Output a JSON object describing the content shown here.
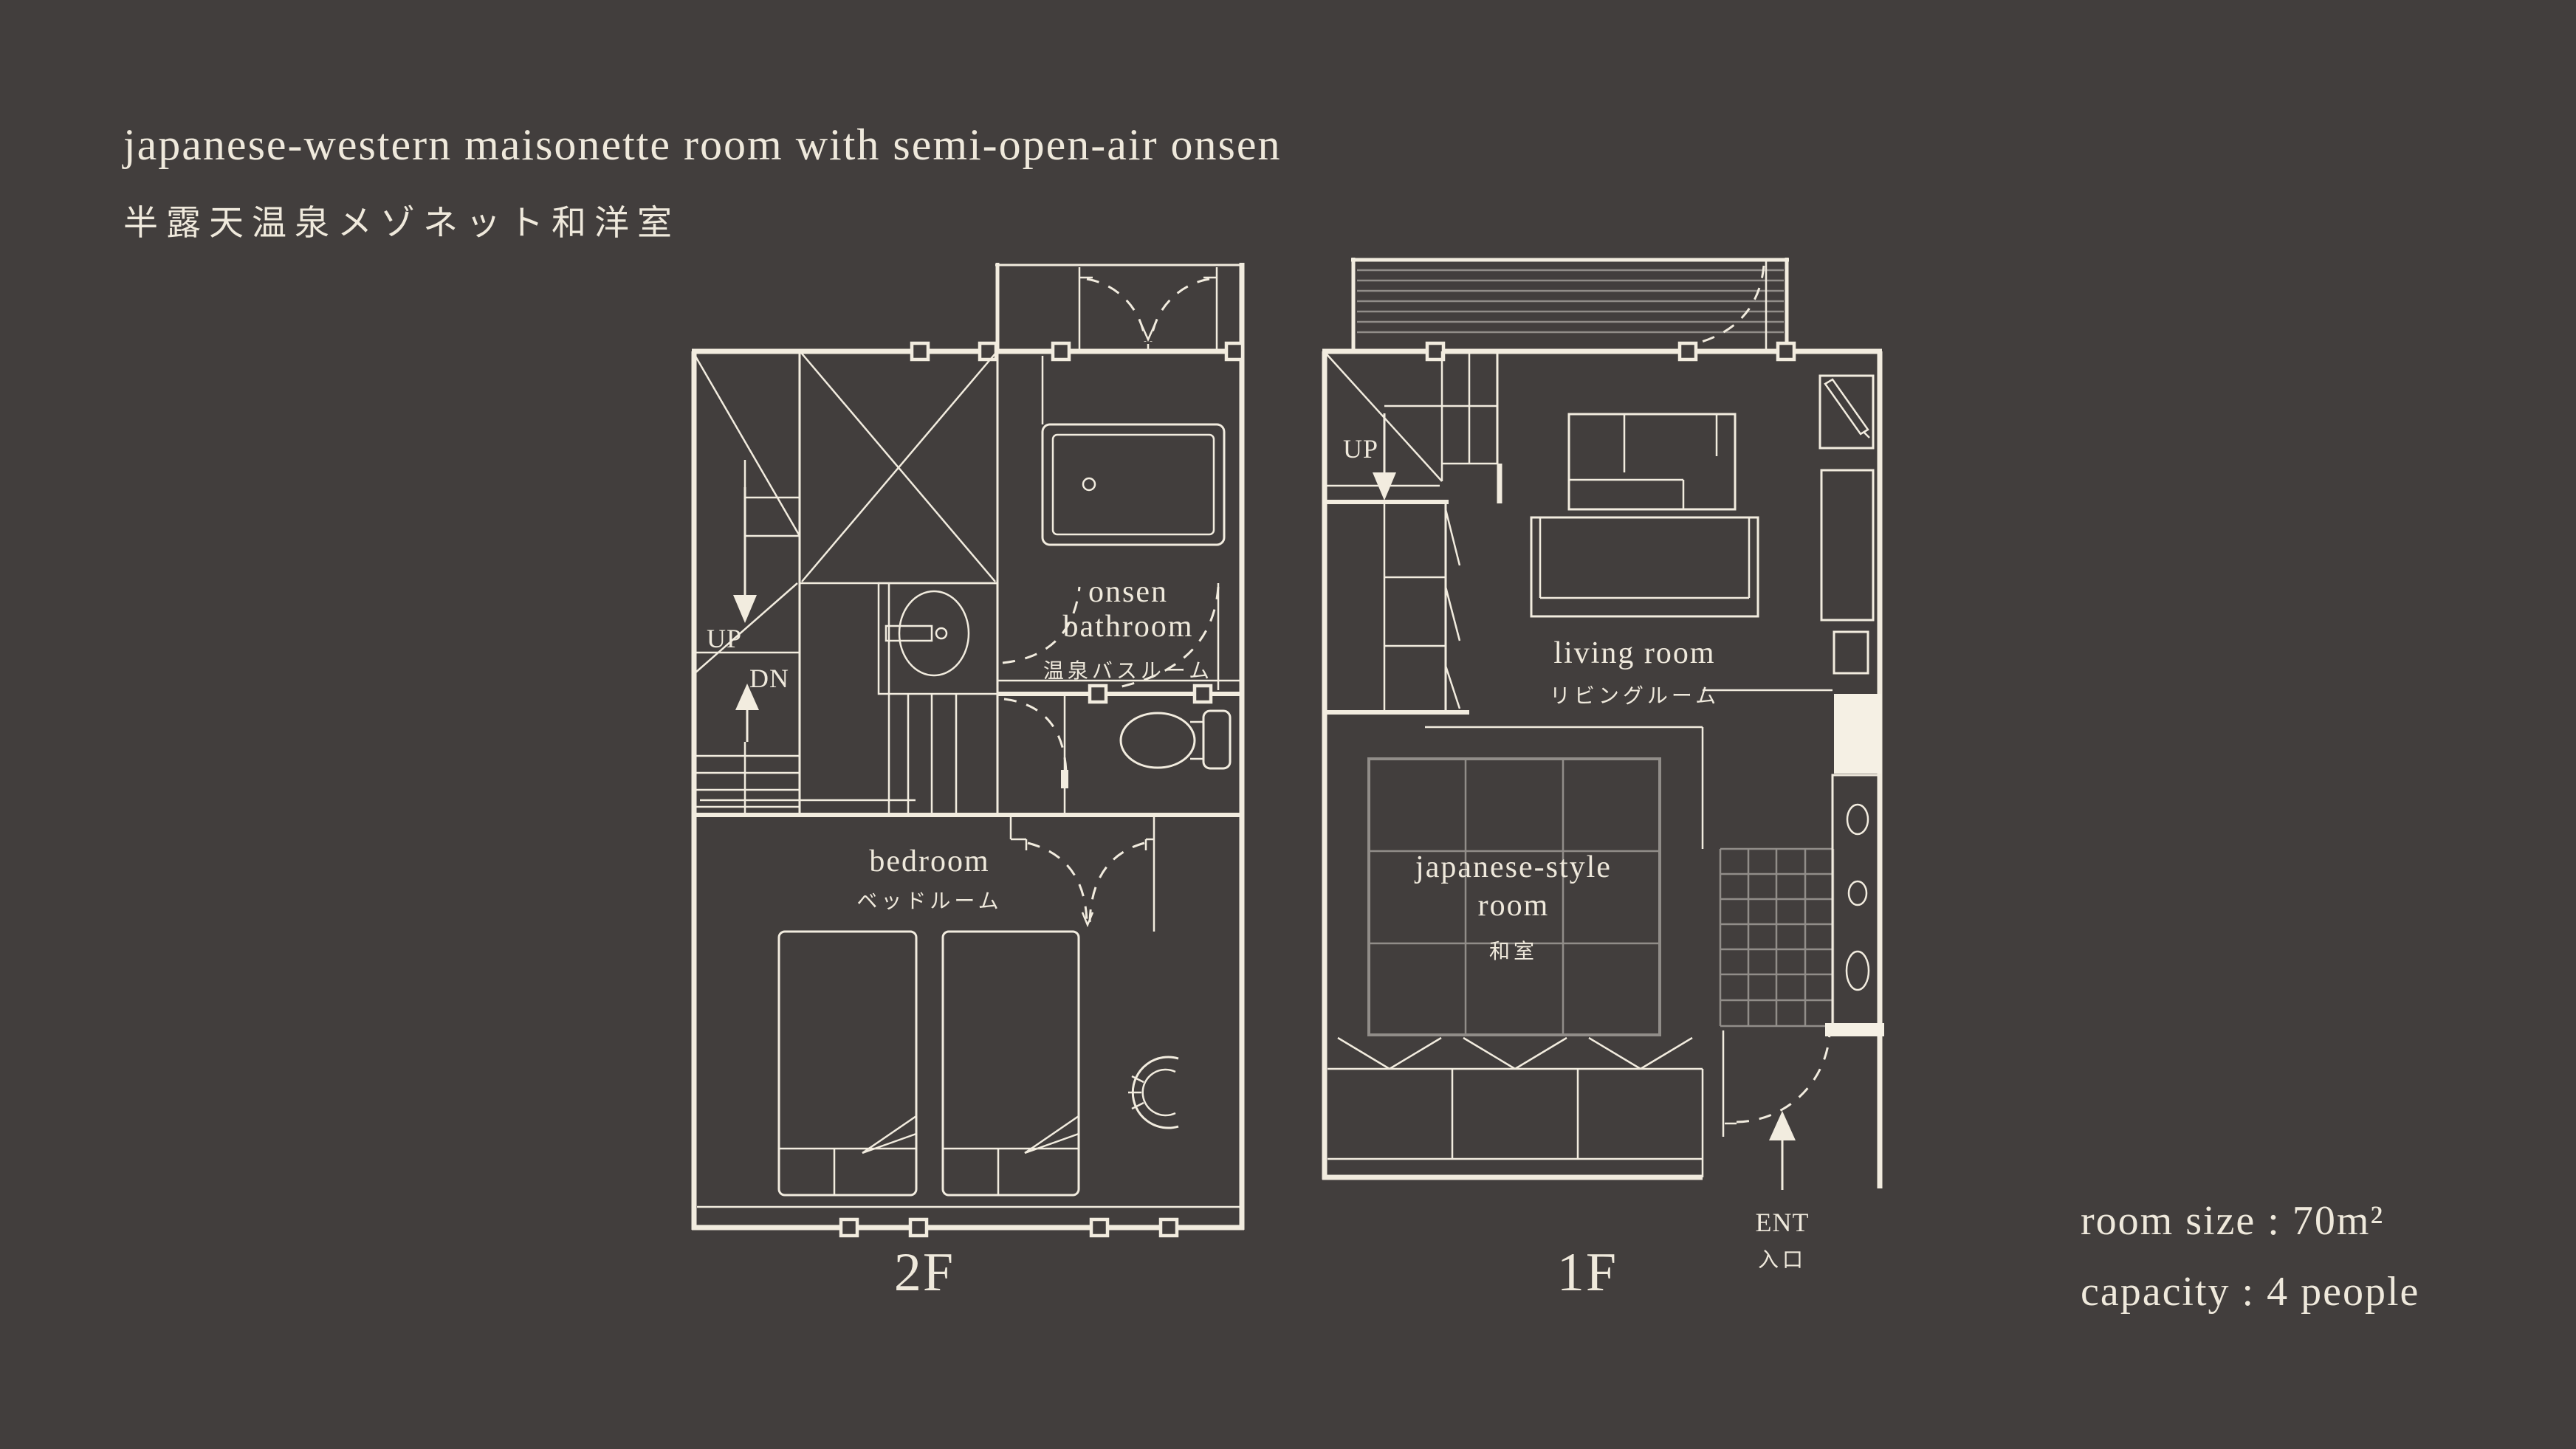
{
  "title": {
    "en": "japanese-western maisonette room with semi-open-air onsen",
    "jp": "半露天温泉メゾネット和洋室"
  },
  "plan2f": {
    "floor_label": "2F",
    "up": "UP",
    "dn": "DN",
    "onsen_line1": "onsen",
    "onsen_line2": "bathroom",
    "onsen_jp": "温泉バスルーム",
    "bedroom": "bedroom",
    "bedroom_jp": "ベッドルーム"
  },
  "plan1f": {
    "floor_label": "1F",
    "up": "UP",
    "living": "living room",
    "living_jp": "リビングルーム",
    "washitsu_line1": "japanese-style",
    "washitsu_line2": "room",
    "washitsu_jp": "和室",
    "entrance": "ENT",
    "entrance_jp": "入口"
  },
  "info": {
    "room_size": "room size : 70m²",
    "capacity": "capacity : 4 people"
  },
  "colors": {
    "background": "#423e3d",
    "line_cream": "#f2ecdf",
    "line_dim_gray": "#918d89",
    "accent_fill": "#f5f0e4",
    "text": "#efe9dc"
  }
}
